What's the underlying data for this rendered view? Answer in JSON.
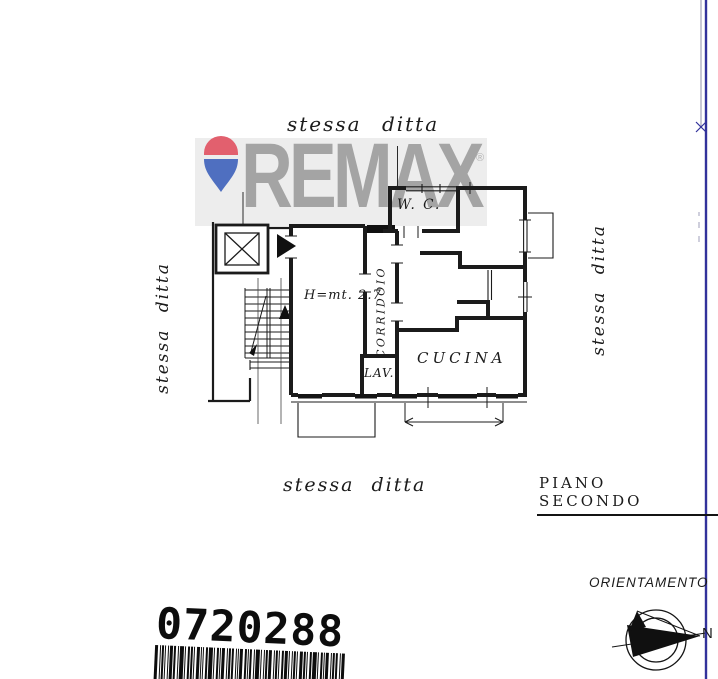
{
  "watermark": {
    "brand": "REMAX",
    "registered": "®"
  },
  "labels": {
    "same_owner_top": "stessa ditta",
    "same_owner_left": "stessa ditta",
    "same_owner_right": "stessa ditta",
    "same_owner_bottom": "stessa ditta",
    "floor": "PIANO SECONDO"
  },
  "plan": {
    "rooms": {
      "wc": "W. C.",
      "corridor": "CORRIDOIO",
      "kitchen": "CUCINA",
      "laundry": "LAV.",
      "ceiling_height": "H=mt. 2.7"
    }
  },
  "orientation": {
    "title": "ORIENTAMENTO",
    "north": "N"
  },
  "barcode": {
    "value": "0720288"
  },
  "colors": {
    "plan_line": "#1b1b1b",
    "edge_line": "#32329b",
    "watermark_gray": "#a4a4a4",
    "watermark_band": "#ededed",
    "balloon_red": "#e2606e",
    "balloon_blue": "#4f6fc0"
  }
}
